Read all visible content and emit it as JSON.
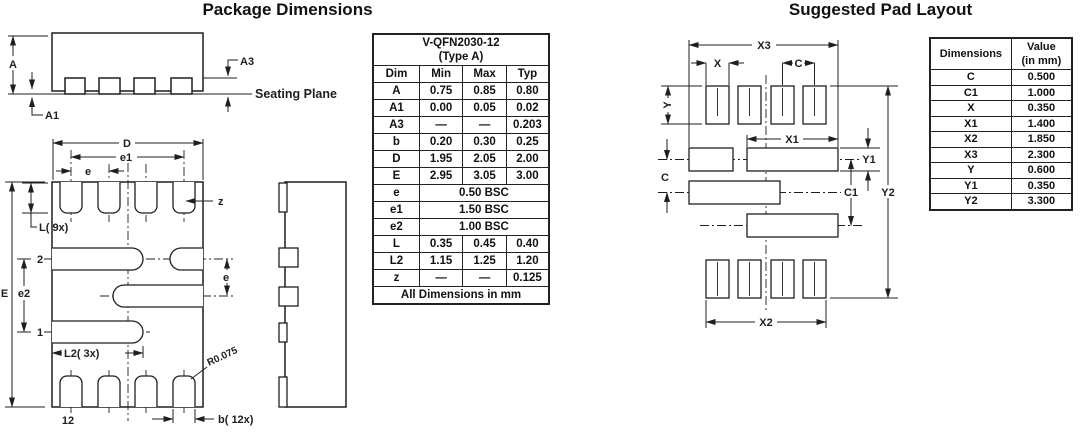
{
  "colors": {
    "ink": "#1f1f1f",
    "background": "#ffffff"
  },
  "titles": {
    "left": "Package Dimensions",
    "right": "Suggested Pad Layout"
  },
  "dim_table": {
    "title_line1": "V-QFN2030-12",
    "title_line2": "(Type A)",
    "headers": [
      "Dim",
      "Min",
      "Max",
      "Typ"
    ],
    "rows": [
      {
        "dim": "A",
        "min": "0.75",
        "max": "0.85",
        "typ": "0.80"
      },
      {
        "dim": "A1",
        "min": "0.00",
        "max": "0.05",
        "typ": "0.02"
      },
      {
        "dim": "A3",
        "min": "—",
        "max": "—",
        "typ": "0.203"
      },
      {
        "dim": "b",
        "min": "0.20",
        "max": "0.30",
        "typ": "0.25"
      },
      {
        "dim": "D",
        "min": "1.95",
        "max": "2.05",
        "typ": "2.00"
      },
      {
        "dim": "E",
        "min": "2.95",
        "max": "3.05",
        "typ": "3.00"
      },
      {
        "dim": "e",
        "span": "0.50 BSC"
      },
      {
        "dim": "e1",
        "span": "1.50 BSC"
      },
      {
        "dim": "e2",
        "span": "1.00 BSC"
      },
      {
        "dim": "L",
        "min": "0.35",
        "max": "0.45",
        "typ": "0.40"
      },
      {
        "dim": "L2",
        "min": "1.15",
        "max": "1.25",
        "typ": "1.20"
      },
      {
        "dim": "z",
        "min": "—",
        "max": "—",
        "typ": "0.125"
      }
    ],
    "footer": "All Dimensions in mm"
  },
  "pad_table": {
    "header_dim": "Dimensions",
    "header_value_line1": "Value",
    "header_value_line2": "(in mm)",
    "rows": [
      {
        "dim": "C",
        "value": "0.500"
      },
      {
        "dim": "C1",
        "value": "1.000"
      },
      {
        "dim": "X",
        "value": "0.350"
      },
      {
        "dim": "X1",
        "value": "1.400"
      },
      {
        "dim": "X2",
        "value": "1.850"
      },
      {
        "dim": "X3",
        "value": "2.300"
      },
      {
        "dim": "Y",
        "value": "0.600"
      },
      {
        "dim": "Y1",
        "value": "0.350"
      },
      {
        "dim": "Y2",
        "value": "3.300"
      }
    ]
  },
  "drawing_labels": {
    "side_view": {
      "a": "A",
      "a1": "A1",
      "a3": "A3",
      "seating_plane": "Seating Plane"
    },
    "bottom_view": {
      "d": "D",
      "e1": "e1",
      "e": "e",
      "z": "z",
      "l": "L( 9x)",
      "e_dim": "E",
      "e2": "e2",
      "pin2": "2",
      "pin1": "1",
      "l2": "L2( 3x)",
      "radius": "R0.075",
      "pin12": "12",
      "b": "b( 12x)",
      "e_right": "e"
    },
    "pad_layout": {
      "x3": "X3",
      "x": "X",
      "c_top": "C",
      "y": "Y",
      "x1": "X1",
      "y1": "Y1",
      "c1": "C1",
      "c_left": "C",
      "y2": "Y2",
      "x2": "X2"
    }
  }
}
